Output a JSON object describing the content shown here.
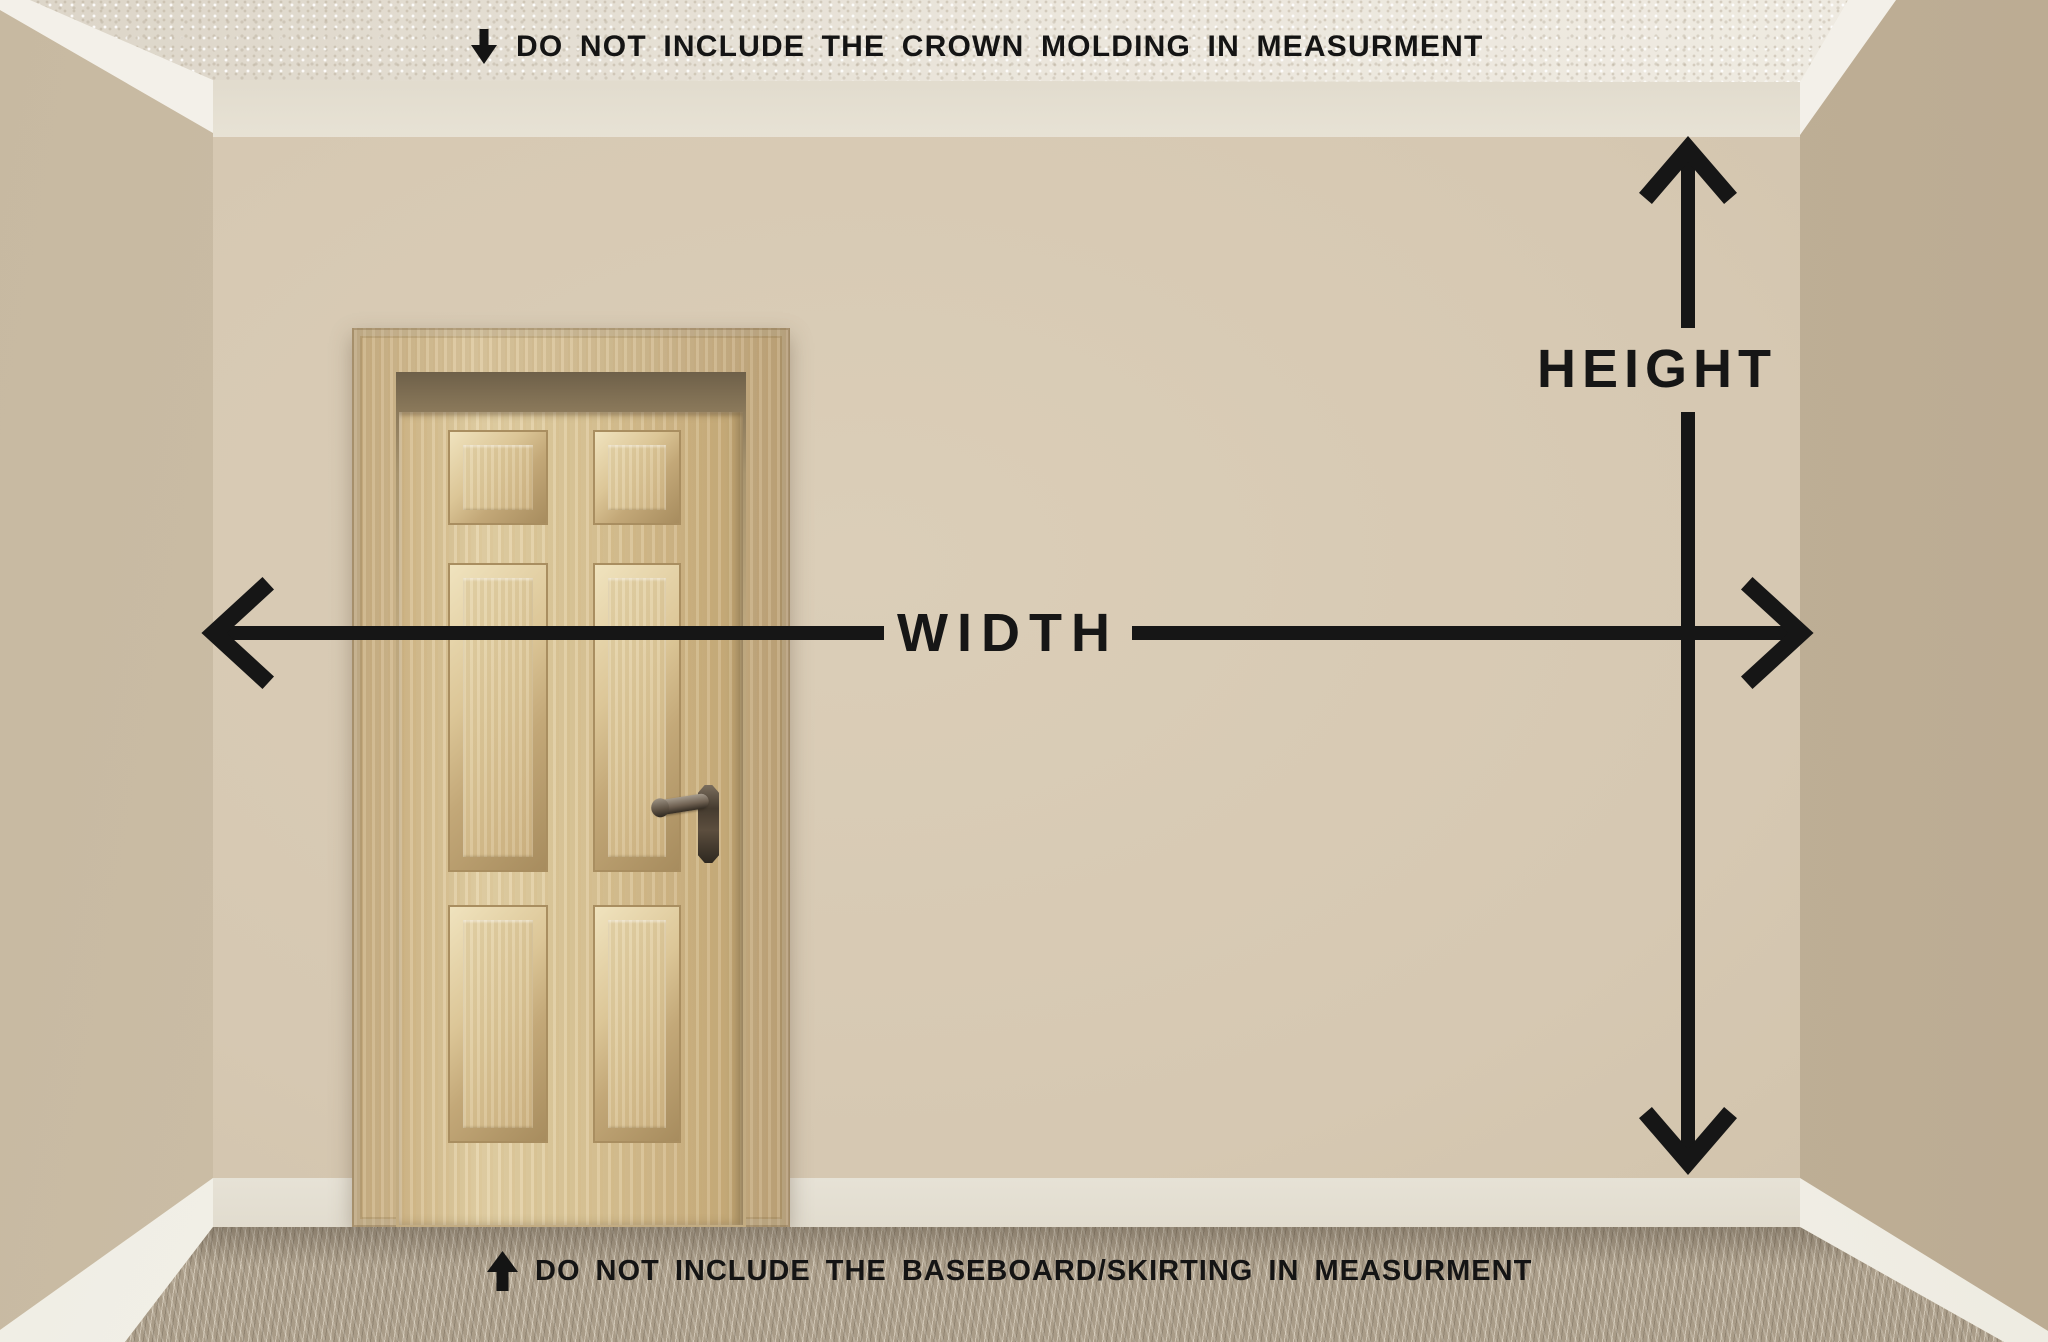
{
  "annotations": {
    "top_note": "DO NOT INCLUDE THE CROWN MOLDING IN MEASURMENT",
    "bottom_note": "DO NOT INCLUDE THE BASEBOARD/SKIRTING IN MEASURMENT",
    "width_label": "WIDTH",
    "height_label": "HEIGHT"
  },
  "icons": {
    "top_note_icon": "arrow-down",
    "bottom_note_icon": "arrow-up",
    "width_arrow": "double-headed-horizontal-arrow",
    "height_arrow": "double-headed-vertical-arrow"
  },
  "colors": {
    "annotation_ink": "#161616",
    "back_wall": "#d6c8b2",
    "left_wall": "#cfc1aa",
    "right_wall": "#c2b39b",
    "ceiling": "#e9e4d9",
    "crown_molding": "#f3f0e9",
    "baseboard": "#f6f4ee",
    "carpet": "#a99c88",
    "door_wood": "#dcc697"
  }
}
